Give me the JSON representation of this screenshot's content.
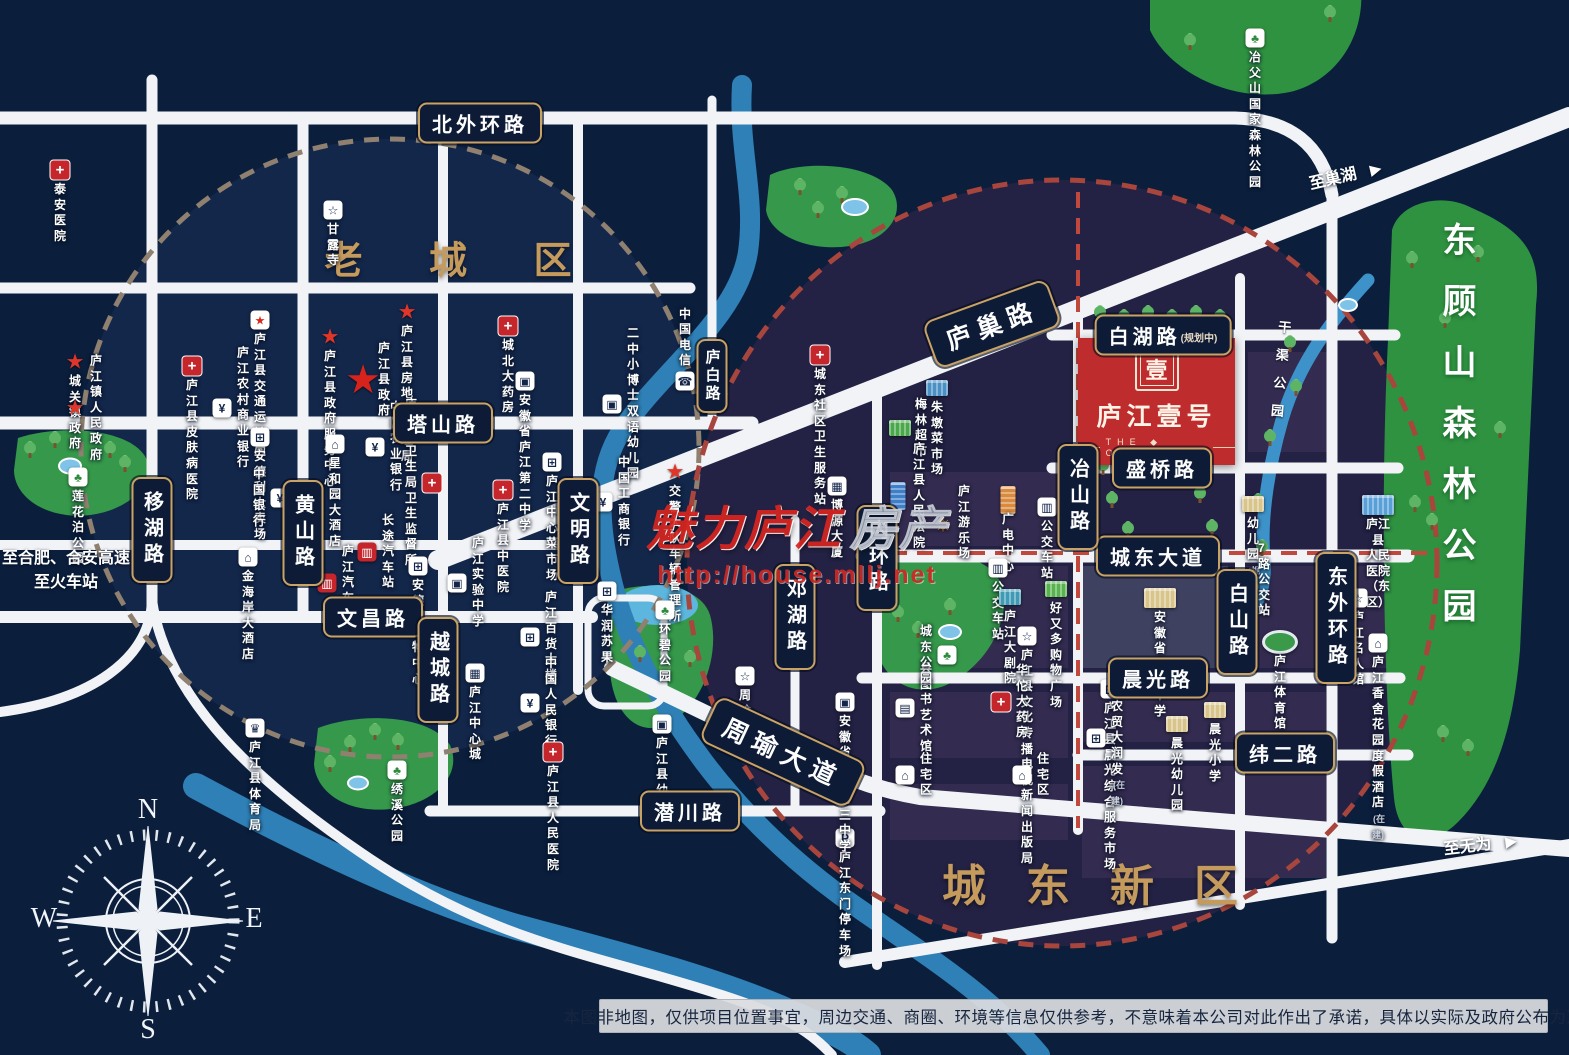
{
  "project": {
    "name": "庐江壹号",
    "en": "THE ◆ ONE",
    "logo_char": "壹"
  },
  "districts": {
    "old": "老 城 区",
    "new": "城东新区"
  },
  "big_parks": {
    "donggushan": "东顾山森林公园",
    "canal": "干渠公园"
  },
  "watermark": {
    "brand": "魅力庐江",
    "suffix": "房产",
    "url": "http://house.mllj.net"
  },
  "compass": {
    "n": "N",
    "e": "E",
    "s": "S",
    "w": "W"
  },
  "disclaimer": "本图非地图，仅供项目位置事宜，周边交通、商圈、环境等信息仅供参考，不意味着本公司对此作出了承诺，具体以实际及政府公布为准",
  "directions": [
    {
      "text": "至巢湖",
      "x": 1345,
      "y": 174,
      "rot": -13,
      "arrow": "▶"
    },
    {
      "text": "至无为",
      "x": 1480,
      "y": 843,
      "rot": -7,
      "arrow": "▶"
    },
    {
      "text": "至合肥、合安高速\n至火车站",
      "x": 66,
      "y": 568,
      "rot": 0,
      "arrow": ""
    }
  ],
  "roads": {
    "badges": [
      {
        "id": "beiwaihuan",
        "text": "北外环路",
        "x": 480,
        "y": 123
      },
      {
        "id": "tashan",
        "text": "塔山路",
        "x": 443,
        "y": 423
      },
      {
        "id": "wenchang",
        "text": "文昌路",
        "x": 373,
        "y": 617
      },
      {
        "id": "qianchuan",
        "text": "潜川路",
        "x": 690,
        "y": 811
      },
      {
        "id": "baihu",
        "text": "白湖路",
        "note": "(规划中)",
        "x": 1163,
        "y": 335
      },
      {
        "id": "shengqiao",
        "text": "盛桥路",
        "x": 1162,
        "y": 468
      },
      {
        "id": "chengdong-avenue",
        "text": "城东大道",
        "x": 1158,
        "y": 556
      },
      {
        "id": "chenguang",
        "text": "晨光路",
        "x": 1158,
        "y": 678
      },
      {
        "id": "weier",
        "text": "纬二路",
        "x": 1285,
        "y": 753
      },
      {
        "id": "yihu",
        "text": "移湖路",
        "x": 152,
        "y": 530,
        "o": "v"
      },
      {
        "id": "huangshan",
        "text": "黄山路",
        "x": 303,
        "y": 533,
        "o": "v"
      },
      {
        "id": "yuecheng",
        "text": "越城路",
        "x": 438,
        "y": 670,
        "o": "v"
      },
      {
        "id": "wenming",
        "text": "文明路",
        "x": 578,
        "y": 531,
        "o": "v"
      },
      {
        "id": "lubai",
        "text": "庐白路",
        "x": 712,
        "y": 376,
        "o": "v",
        "small": 1
      },
      {
        "id": "denghu",
        "text": "邓湖路",
        "x": 795,
        "y": 617,
        "o": "v"
      },
      {
        "id": "neihuan",
        "text": "内环路",
        "x": 877,
        "y": 558,
        "o": "v"
      },
      {
        "id": "yeshan",
        "text": "冶山路",
        "x": 1078,
        "y": 497,
        "o": "v"
      },
      {
        "id": "baishan",
        "text": "白山路",
        "x": 1237,
        "y": 622,
        "o": "v"
      },
      {
        "id": "dongwaihuan",
        "text": "东外环路",
        "x": 1336,
        "y": 618,
        "o": "v"
      },
      {
        "id": "luchao",
        "text": "庐巢路",
        "x": 992,
        "y": 324,
        "rot": -20
      },
      {
        "id": "zhouyu-avenue",
        "text": "周瑜大道",
        "x": 783,
        "y": 752,
        "rot": 25
      }
    ]
  },
  "pois": [
    {
      "n": "taian-hospital",
      "label": "泰安医院",
      "x": 60,
      "y": 170,
      "t": "cross",
      "lp": "b"
    },
    {
      "n": "ganlu-temple",
      "label": "甘露寺",
      "x": 333,
      "y": 210,
      "t": "box",
      "g": "☆",
      "icon": "temple-icon",
      "lp": "b"
    },
    {
      "n": "transport-bureau",
      "label": "庐江县\n交通运输局",
      "x": 260,
      "y": 320,
      "t": "starbox",
      "icon": "gov-star-icon",
      "lp": "b"
    },
    {
      "n": "chengguan-gov",
      "label": "城关镇政府",
      "x": 75,
      "y": 362,
      "t": "star",
      "lp": "b"
    },
    {
      "n": "skin-hospital",
      "label": "庐江县皮肤病医院",
      "x": 192,
      "y": 366,
      "t": "cross",
      "lp": "b"
    },
    {
      "n": "town-gov",
      "label": "庐江镇人民政府",
      "x": 75,
      "y": 408,
      "t": "star",
      "lp": "r"
    },
    {
      "n": "gov-service-center",
      "label": "庐江县政府\n服务中心",
      "x": 330,
      "y": 337,
      "t": "star",
      "lp": "b"
    },
    {
      "n": "realestate-bureau",
      "label": "庐江县\n房地产管理局",
      "x": 407,
      "y": 312,
      "t": "star",
      "lp": "b"
    },
    {
      "n": "county-gov",
      "label": "庐江县政府",
      "x": 363,
      "y": 380,
      "t": "bigstar",
      "lp": "r"
    },
    {
      "n": "chengbei-pharmacy",
      "label": "城北大药房",
      "x": 508,
      "y": 326,
      "t": "cross",
      "lp": "b"
    },
    {
      "n": "rural-bank",
      "label": "庐江农村商业银行",
      "x": 222,
      "y": 408,
      "t": "box",
      "g": "¥",
      "icon": "bank-icon",
      "lp": "r"
    },
    {
      "n": "no2-middle-school",
      "label": "安徽省\n庐江第二中学",
      "x": 525,
      "y": 381,
      "t": "box",
      "g": "▣",
      "icon": "school-icon",
      "lp": "b"
    },
    {
      "n": "xiaoboshi-kindergarten",
      "label": "二中小博士\n双语幼儿园",
      "x": 612,
      "y": 404,
      "t": "box",
      "g": "▣",
      "icon": "school-icon",
      "lp": "r"
    },
    {
      "n": "china-telecom",
      "label": "中国电信",
      "x": 685,
      "y": 381,
      "t": "box",
      "g": "☎",
      "icon": "telecom-icon",
      "lp": "t"
    },
    {
      "n": "andeli-mart",
      "label": "安德利大卖场",
      "x": 260,
      "y": 437,
      "t": "box",
      "g": "⊞",
      "icon": "mall-icon",
      "lp": "b"
    },
    {
      "n": "xingheyuan-hotel",
      "label": "星和园大酒店",
      "x": 335,
      "y": 444,
      "t": "box",
      "g": "⌂",
      "icon": "hotel-icon",
      "lp": "b"
    },
    {
      "n": "agri-bank",
      "label": "中国农业\n银行",
      "x": 375,
      "y": 447,
      "t": "box",
      "g": "¥",
      "icon": "bank-icon",
      "lp": "r"
    },
    {
      "n": "health-bureau",
      "label": "庐江县卫生局\n卫生监督所",
      "x": 432,
      "y": 483,
      "t": "cross",
      "lp": "l"
    },
    {
      "n": "central-market",
      "label": "庐江中心\n菜市场",
      "x": 552,
      "y": 462,
      "t": "box",
      "g": "⊞",
      "icon": "market-icon",
      "lp": "b"
    },
    {
      "n": "tcm-hospital",
      "label": "庐江县中医院",
      "x": 503,
      "y": 490,
      "t": "cross",
      "lp": "b"
    },
    {
      "n": "bank-of-china",
      "label": "中国银行",
      "x": 280,
      "y": 498,
      "t": "box",
      "g": "¥",
      "icon": "bank-icon",
      "lp": "l"
    },
    {
      "n": "jinhaian-hotel",
      "label": "金海岸大酒店",
      "x": 248,
      "y": 557,
      "t": "box",
      "g": "⌂",
      "icon": "hotel-icon",
      "lp": "b"
    },
    {
      "n": "longdist-bus-station",
      "label": "长途汽车站",
      "x": 367,
      "y": 552,
      "t": "box",
      "g": "▥",
      "c": "#c4262b",
      "gc": "#fff",
      "icon": "bus-icon",
      "lp": "r"
    },
    {
      "n": "andeli-shopping",
      "label": "安德利\n购物中心",
      "x": 418,
      "y": 566,
      "t": "box",
      "g": "⊞",
      "icon": "mall-icon",
      "lp": "b"
    },
    {
      "n": "lujiang-bus-station",
      "label": "庐江汽车站",
      "x": 327,
      "y": 583,
      "t": "box",
      "g": "▥",
      "c": "#c4262b",
      "gc": "#fff",
      "icon": "bus-icon",
      "lp": "r"
    },
    {
      "n": "shiyan-school",
      "label": "庐江实验中学",
      "x": 457,
      "y": 583,
      "t": "box",
      "g": "▣",
      "icon": "school-icon",
      "lp": "r"
    },
    {
      "n": "icbc-bank",
      "label": "中国工商\n银行",
      "x": 603,
      "y": 502,
      "t": "box",
      "g": "¥",
      "icon": "bank-icon",
      "lp": "r"
    },
    {
      "n": "traffic-police",
      "label": "交警大队\n车辆管理所",
      "x": 675,
      "y": 472,
      "t": "star",
      "lp": "b"
    },
    {
      "n": "huarun-suguo",
      "label": "华润苏果",
      "x": 607,
      "y": 591,
      "t": "box",
      "g": "⊞",
      "icon": "market-icon",
      "lp": "b"
    },
    {
      "n": "department-store",
      "label": "庐江\n百货大楼",
      "x": 530,
      "y": 637,
      "t": "box",
      "g": "⊞",
      "icon": "mall-icon",
      "lp": "r"
    },
    {
      "n": "center-city",
      "label": "庐江\n中心城",
      "x": 475,
      "y": 673,
      "t": "box",
      "g": "▦",
      "icon": "mall-icon",
      "lp": "b"
    },
    {
      "n": "peoples-bank",
      "label": "中国人民\n银行",
      "x": 530,
      "y": 703,
      "t": "box",
      "g": "¥",
      "icon": "bank-icon",
      "lp": "r"
    },
    {
      "n": "sports-bureau",
      "label": "庐江县体育局",
      "x": 255,
      "y": 728,
      "t": "box",
      "g": "♛",
      "icon": "sports-icon",
      "lp": "b"
    },
    {
      "n": "peoples-hospital",
      "label": "庐江县\n人民医院",
      "x": 553,
      "y": 752,
      "t": "cross",
      "lp": "b"
    },
    {
      "n": "county-kindergarten",
      "label": "庐江县幼儿园",
      "x": 662,
      "y": 724,
      "t": "box",
      "g": "▣",
      "icon": "school-icon",
      "lp": "b"
    },
    {
      "n": "zhouyu-tomb",
      "label": "周瑜墓园",
      "x": 745,
      "y": 676,
      "t": "box",
      "g": "☆",
      "icon": "temple-icon",
      "lp": "b"
    },
    {
      "n": "chengdong-clinic",
      "label": "城东社区\n卫生服务站",
      "x": 820,
      "y": 355,
      "t": "cross",
      "lp": "b"
    },
    {
      "n": "zhudun-market",
      "label": "朱墩菜市场",
      "x": 937,
      "y": 388,
      "t": "bldg",
      "c": "#4a90c4",
      "lp": "b"
    },
    {
      "n": "meilin-market",
      "label": "梅林超市",
      "x": 900,
      "y": 428,
      "t": "bldg",
      "c": "#49a84c",
      "lp": "r"
    },
    {
      "n": "boyuan-tower",
      "label": "博源大厦",
      "x": 837,
      "y": 486,
      "t": "box",
      "g": "▦",
      "icon": "building-icon",
      "lp": "b"
    },
    {
      "n": "county-court",
      "label": "庐江县\n人民法院",
      "x": 898,
      "y": 496,
      "t": "bldg",
      "c": "#3f7fc9",
      "tall": 1,
      "lp": "r"
    },
    {
      "n": "amusement-park",
      "label": "庐江游乐场",
      "x": 943,
      "y": 523,
      "t": "ferris",
      "lp": "r"
    },
    {
      "n": "broadcast-center",
      "label": "广电中心",
      "x": 1008,
      "y": 500,
      "t": "bldg",
      "c": "#d98a3c",
      "tall": 1,
      "lp": "b"
    },
    {
      "n": "bus-stop-1",
      "label": "公交车站",
      "x": 1047,
      "y": 507,
      "t": "box",
      "g": "▥",
      "icon": "bus-icon",
      "lp": "b"
    },
    {
      "n": "bus-stop-2",
      "label": "公交车站",
      "x": 998,
      "y": 568,
      "t": "box",
      "g": "▥",
      "icon": "bus-icon",
      "lp": "b"
    },
    {
      "n": "haoyouduo-plaza",
      "label": "好又多\n购物广场",
      "x": 1056,
      "y": 589,
      "t": "bldg",
      "c": "#58b24e",
      "lp": "b"
    },
    {
      "n": "grand-theater",
      "label": "庐江大剧院",
      "x": 1010,
      "y": 597,
      "t": "bldg",
      "c": "#3f9bb5",
      "lp": "b"
    },
    {
      "n": "culture-bureau",
      "label": "庐江县文化传播\n电视新闻出版局",
      "x": 1027,
      "y": 636,
      "t": "box",
      "g": "☆",
      "icon": "temple-icon",
      "lp": "b"
    },
    {
      "n": "lujiang-middle-school",
      "label": "安徽省庐江中学",
      "x": 1160,
      "y": 598,
      "t": "bldg",
      "c": "#d8c58c",
      "big": 1,
      "lp": "b"
    },
    {
      "n": "huatuo-pharmacy",
      "label": "华佗大药房",
      "x": 1001,
      "y": 702,
      "t": "cross",
      "lp": "r"
    },
    {
      "n": "chenguang-service-market",
      "label": "庐江县晨光\n综合服务市场",
      "x": 1110,
      "y": 689,
      "t": "box",
      "g": "⊞",
      "icon": "mall-icon",
      "lp": "b"
    },
    {
      "n": "darunfa",
      "label": "晨光农贸\n大润发",
      "x": 1096,
      "y": 738,
      "t": "box",
      "g": "⊞",
      "icon": "mall-icon",
      "lp": "r",
      "note": "(在建)"
    },
    {
      "n": "chenguang-kindergarten",
      "label": "晨光幼儿园",
      "x": 1177,
      "y": 724,
      "t": "bldg",
      "c": "#d8c58c",
      "lp": "b"
    },
    {
      "n": "chenguang-primary",
      "label": "晨光小学",
      "x": 1215,
      "y": 710,
      "t": "bldg",
      "c": "#d8c58c",
      "lp": "b"
    },
    {
      "n": "library-art-hall",
      "label": "县图书艺术馆",
      "x": 905,
      "y": 708,
      "t": "box",
      "g": "▤",
      "icon": "book-icon",
      "lp": "r"
    },
    {
      "n": "residence-1",
      "label": "住宅区",
      "x": 905,
      "y": 775,
      "t": "box",
      "g": "⌂",
      "icon": "home-icon",
      "lp": "r"
    },
    {
      "n": "residence-2",
      "label": "住宅区",
      "x": 1022,
      "y": 775,
      "t": "box",
      "g": "⌂",
      "icon": "home-icon",
      "lp": "r"
    },
    {
      "n": "east-gate-parking",
      "label": "庐江东门停车场",
      "x": 845,
      "y": 838,
      "t": "box",
      "g": "P",
      "icon": "parking-icon",
      "lp": "b"
    },
    {
      "n": "no3-middle-school",
      "label": "安徽省\n庐江第三中学",
      "x": 845,
      "y": 702,
      "t": "box",
      "g": "▣",
      "icon": "school-icon",
      "lp": "b"
    },
    {
      "n": "kindergarten-planned",
      "label": "幼儿园",
      "x": 1253,
      "y": 504,
      "t": "bldg",
      "c": "#d8c58c",
      "lp": "b",
      "note": "(规划)"
    },
    {
      "n": "east-peoples-hospital",
      "label": "庐江县\n人民医院（东区）",
      "x": 1378,
      "y": 505,
      "t": "bldg",
      "c": "#5aa0d8",
      "big": 1,
      "lp": "b"
    },
    {
      "n": "bus-route-7",
      "label": "7路公交站",
      "x": 1243,
      "y": 580,
      "t": "box",
      "g": "▥",
      "icon": "bus-icon",
      "lp": "r"
    },
    {
      "n": "mingren-hall",
      "label": "庐江名人馆",
      "x": 1358,
      "y": 598,
      "t": "box",
      "g": "☆",
      "icon": "temple-icon",
      "lp": "b"
    },
    {
      "n": "xiangshe-resort",
      "label": "庐江香舍花园\n度假酒店",
      "x": 1378,
      "y": 643,
      "t": "box",
      "g": "⌂",
      "icon": "hotel-icon",
      "lp": "b",
      "note": "(在建)"
    },
    {
      "n": "stadium",
      "label": "庐江体育馆",
      "x": 1280,
      "y": 642,
      "t": "stadium",
      "lp": "b"
    },
    {
      "n": "yefushan-park",
      "label": "冶父山国家森林公园",
      "x": 1255,
      "y": 38,
      "t": "box",
      "g": "♣",
      "gc": "#2e8b3d",
      "c": "#fff",
      "icon": "park-icon",
      "lp": "b"
    },
    {
      "n": "lianhuapo-park",
      "label": "莲花泊公园",
      "x": 78,
      "y": 477,
      "t": "box",
      "g": "♣",
      "gc": "#2e8b3d",
      "c": "#fff",
      "icon": "park-icon",
      "lp": "b"
    },
    {
      "n": "huanbi-park",
      "label": "环碧公园",
      "x": 665,
      "y": 610,
      "t": "box",
      "g": "♣",
      "gc": "#2e8b3d",
      "c": "#fff",
      "icon": "park-icon",
      "lp": "b"
    },
    {
      "n": "chengdong-park",
      "label": "城东公园",
      "x": 947,
      "y": 655,
      "t": "box",
      "g": "♣",
      "gc": "#2e8b3d",
      "c": "#fff",
      "icon": "park-icon",
      "lp": "l"
    },
    {
      "n": "xiuxi-park",
      "label": "绣溪公园",
      "x": 397,
      "y": 770,
      "t": "box",
      "g": "♣",
      "gc": "#2e8b3d",
      "c": "#fff",
      "icon": "park-icon",
      "lp": "b"
    }
  ],
  "trees": [
    {
      "x": 1190,
      "y": 50
    },
    {
      "x": 1330,
      "y": 22
    },
    {
      "x": 800,
      "y": 195
    },
    {
      "x": 818,
      "y": 218
    },
    {
      "x": 842,
      "y": 203
    },
    {
      "x": 1100,
      "y": 322
    },
    {
      "x": 1124,
      "y": 326
    },
    {
      "x": 1148,
      "y": 322
    },
    {
      "x": 1172,
      "y": 326
    },
    {
      "x": 1196,
      "y": 322
    },
    {
      "x": 1220,
      "y": 326
    },
    {
      "x": 1103,
      "y": 475
    },
    {
      "x": 1112,
      "y": 508
    },
    {
      "x": 1128,
      "y": 538
    },
    {
      "x": 1200,
      "y": 503
    },
    {
      "x": 1212,
      "y": 536
    },
    {
      "x": 1290,
      "y": 352
    },
    {
      "x": 1296,
      "y": 396
    },
    {
      "x": 1270,
      "y": 446
    },
    {
      "x": 1258,
      "y": 510
    },
    {
      "x": 1262,
      "y": 556
    },
    {
      "x": 350,
      "y": 752
    },
    {
      "x": 375,
      "y": 740
    },
    {
      "x": 398,
      "y": 750
    },
    {
      "x": 330,
      "y": 772
    },
    {
      "x": 640,
      "y": 662
    },
    {
      "x": 665,
      "y": 677
    },
    {
      "x": 690,
      "y": 667
    },
    {
      "x": 898,
      "y": 622
    },
    {
      "x": 918,
      "y": 638
    },
    {
      "x": 950,
      "y": 615
    },
    {
      "x": 1412,
      "y": 268
    },
    {
      "x": 1478,
      "y": 262
    },
    {
      "x": 1445,
      "y": 328
    },
    {
      "x": 1415,
      "y": 512
    },
    {
      "x": 1432,
      "y": 530
    },
    {
      "x": 1500,
      "y": 438
    },
    {
      "x": 1443,
      "y": 742
    },
    {
      "x": 1468,
      "y": 756
    },
    {
      "x": 30,
      "y": 458
    },
    {
      "x": 55,
      "y": 448
    },
    {
      "x": 110,
      "y": 458
    },
    {
      "x": 125,
      "y": 472
    }
  ]
}
